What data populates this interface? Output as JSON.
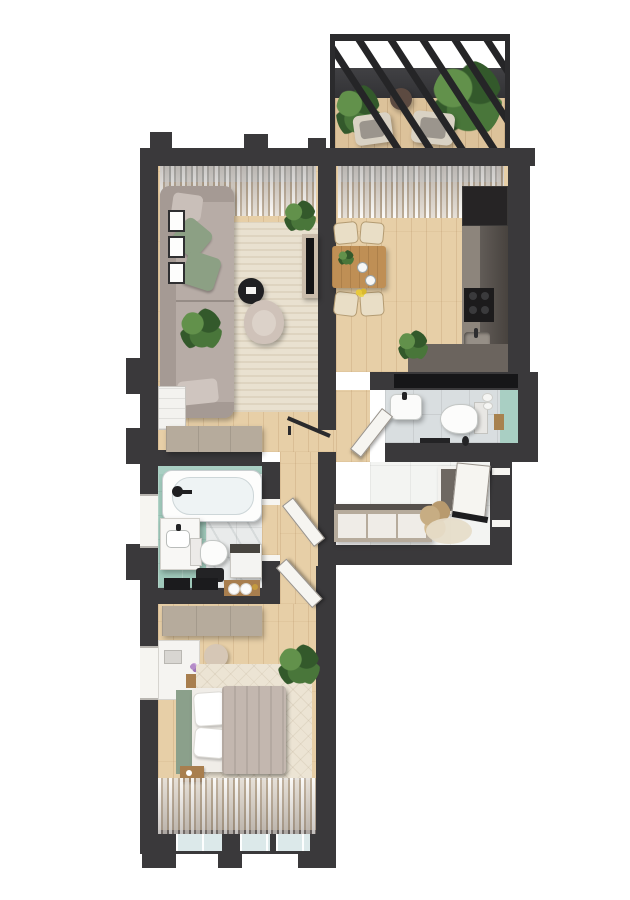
{
  "scene": {
    "type": "apartment-floor-plan",
    "style": "top-down 3D architectural render",
    "background": "#ffffff",
    "text_labels": []
  },
  "palette": {
    "wall": "#3a393b",
    "wood": "#e7cfa7",
    "woodB": "#dcc29a",
    "glass": "#dce9ea",
    "rug": "#e9e1d0",
    "rugBed": "#ece4d4",
    "sofa": "#b7aca6",
    "sofaDark": "#a59a94",
    "pillowGreen": "#8ca084",
    "pillowGray": "#c9bfb9",
    "mint": "#a9cfc3",
    "mintFloor": "#9fc8ba",
    "marble": "#e9ebeb",
    "tileGray": "#d9dee0",
    "tileWhite": "#f3f4f2",
    "tan": "#b6ab9c",
    "counter": "#6b645e",
    "counterLight": "#8d857c",
    "cabinet": "#544e49",
    "unit": "#262425",
    "blackish": "#1d1d1f",
    "doorWhite": "#f6f5f1",
    "blanket": "#c3b7af",
    "headboard": "#8ba08b",
    "cream": "#e9dec6",
    "tableWood": "#bf8f55",
    "armchair": "#cfc2b9",
    "plantA": "#33592b",
    "plantB": "#49763a",
    "plantC": "#62914b",
    "pampas": "#c7ad83",
    "screenDark": "#414144"
  },
  "rooms": [
    {
      "id": "balcony",
      "name": "Balcony",
      "floor": "wood deck",
      "furniture": [
        "pergola-glass-roof-beams",
        "privacy-screen",
        "palm-plant-left",
        "palm-plant-right",
        "small-plant",
        "round-side-table",
        "lounge-chair-left",
        "lounge-chair-right"
      ]
    },
    {
      "id": "living-room",
      "name": "Living room",
      "floor": "wood planks",
      "furniture": [
        "sheer-curtains",
        "window",
        "corner-sofa",
        "green-pillows",
        "gray-pillow",
        "throw",
        "area-rug",
        "round-coffee-table",
        "armchair",
        "tv-console",
        "tv",
        "picture-frames x3",
        "potted-plant x2",
        "white-cabinet",
        "hall-wardrobe"
      ]
    },
    {
      "id": "kitchen-dining",
      "name": "Kitchen / dining room",
      "floor": "wood planks",
      "furniture": [
        "sheer-curtains",
        "window",
        "dining-table",
        "dining-chairs x4",
        "table-plant",
        "plates",
        "yellow-flowers",
        "tall-dark-unit",
        "kitchen-counter",
        "cooktop",
        "sink",
        "counter-plant"
      ]
    },
    {
      "id": "wc",
      "name": "Guest WC",
      "floor": "gray tile",
      "furniture": [
        "green-accent-wall",
        "wall-niche",
        "washbasin",
        "toilet",
        "toilet-brush",
        "towel-rail",
        "paper-rolls",
        "wood-box",
        "door-leaf"
      ]
    },
    {
      "id": "hallway",
      "name": "Entry hall",
      "floor": "white tile",
      "furniture": [
        "entrance-door",
        "leaning-mirror",
        "sideboard",
        "pampas-plant",
        "round-rug"
      ]
    },
    {
      "id": "bathroom",
      "name": "Bathroom",
      "floor": "mint + marble tile",
      "furniture": [
        "bathtub",
        "faucet",
        "window-niche",
        "vanity-sink",
        "toilet",
        "black-stool",
        "washing-machine",
        "wood-shelf-towels",
        "black-cabinet-fronts",
        "door-leaf"
      ]
    },
    {
      "id": "bedroom",
      "name": "Bedroom",
      "floor": "wood planks",
      "furniture": [
        "wardrobe",
        "desk-vanity",
        "pouf",
        "flower-vase",
        "nightstand x2",
        "bed",
        "green-headboard",
        "pillows x2",
        "blanket",
        "diamond-rug",
        "potted-plant",
        "sheer-curtains",
        "window-wall",
        "door-leaf"
      ]
    }
  ],
  "doors": [
    "entrance-door-hall-right",
    "living-room-glass-door",
    "wc-door",
    "bathroom-door",
    "bedroom-door"
  ],
  "windows": [
    "living-room-top",
    "dining-top",
    "bathroom-left",
    "bedroom-left",
    "bedroom-bottom x3"
  ]
}
